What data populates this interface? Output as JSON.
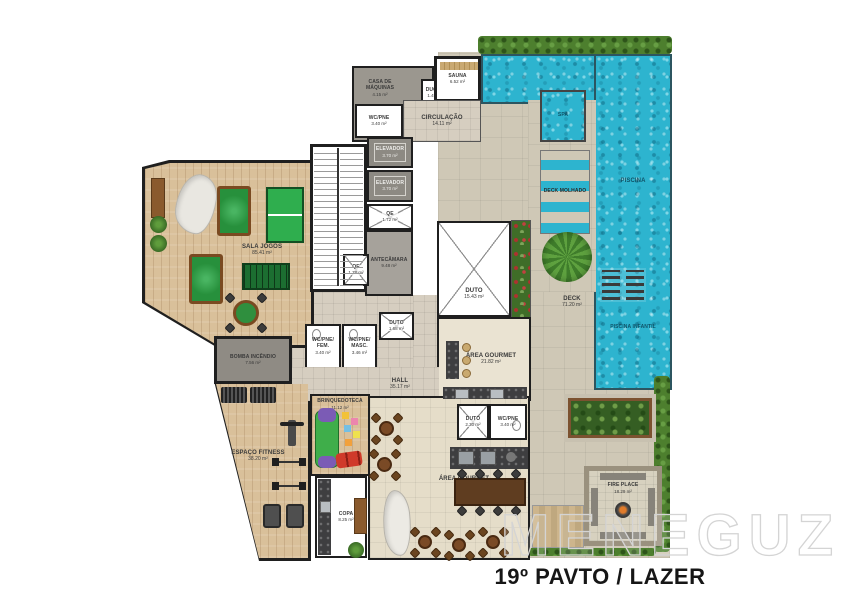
{
  "title": "19º PAVTO / LAZER",
  "watermark": "MENEGUZ",
  "colors": {
    "wall": "#1f1f1f",
    "pool_water": "#2db4cf",
    "wood_floor": "#d9c09a",
    "deck_stone": "#cfc8b6",
    "hedge_green": "#4d7f2e"
  },
  "rooms": {
    "sala_jogos": {
      "name": "SALA JOGOS",
      "area": "85.41 m²"
    },
    "casa_maquinas": {
      "name": "CASA DE MÁQUINAS",
      "area": "4.15 m²"
    },
    "ducha": {
      "name": "DUCHA",
      "area": "1.49 m²"
    },
    "sauna": {
      "name": "SAUNA",
      "area": "6.52 m²"
    },
    "wc_pne_sup": {
      "name": "WC/PNE",
      "area": "3.40 m²"
    },
    "circulacao": {
      "name": "CIRCULAÇÃO",
      "area": "14.11 m²"
    },
    "elevador_1": {
      "name": "ELEVADOR",
      "area": "3.70 m²"
    },
    "elevador_2": {
      "name": "ELEVADOR",
      "area": "3.70 m²"
    },
    "qe_1": {
      "name": "QE",
      "area": "1.72 m²"
    },
    "qe_2": {
      "name": "QE",
      "area": "1.78 m²"
    },
    "antecamara": {
      "name": "ANTECÂMARA",
      "area": "9.48 m²"
    },
    "duto_principal": {
      "name": "DUTO",
      "area": "15.43 m²"
    },
    "spa": {
      "name": "SPA",
      "area": ""
    },
    "deck_molhado": {
      "name": "DECK MOLHADO",
      "area": ""
    },
    "piscina": {
      "name": "PISCINA",
      "area": ""
    },
    "piscina_infantil": {
      "name": "PISCINA INFANTIL",
      "area": ""
    },
    "deck": {
      "name": "DECK",
      "area": "71.20 m²"
    },
    "bomba_incendio": {
      "name": "BOMBA INCÊNDIO",
      "area": "7.56 m²"
    },
    "wc_fem": {
      "name": "WC/PNE/ FEM.",
      "area": "3.40 m²"
    },
    "wc_masc": {
      "name": "WC/PNE/ MASC.",
      "area": "3.46 m²"
    },
    "hall": {
      "name": "HALL",
      "area": "35.17 m²"
    },
    "duto_hall": {
      "name": "DUTO",
      "area": "1.68 m²"
    },
    "area_gourmet_sup": {
      "name": "ÁREA GOURMET",
      "area": "21.82 m²"
    },
    "duto_gourmet": {
      "name": "DUTO",
      "area": "2.30 m²"
    },
    "wc_pne_gourmet": {
      "name": "WC/PNE",
      "area": "3.40 m²"
    },
    "brinquedoteca": {
      "name": "BRINQUEDOTECA",
      "area": "11.12 m²"
    },
    "espaco_fitness": {
      "name": "ESPAÇO FITNESS",
      "area": "38.20 m²"
    },
    "area_gourmet_inf": {
      "name": "ÁREA GOURMET",
      "area": "60.45 m²"
    },
    "copa": {
      "name": "COPA",
      "area": "8.25 m²"
    },
    "fire_place": {
      "name": "FIRE PLACE",
      "area": "18.29 m²"
    }
  }
}
